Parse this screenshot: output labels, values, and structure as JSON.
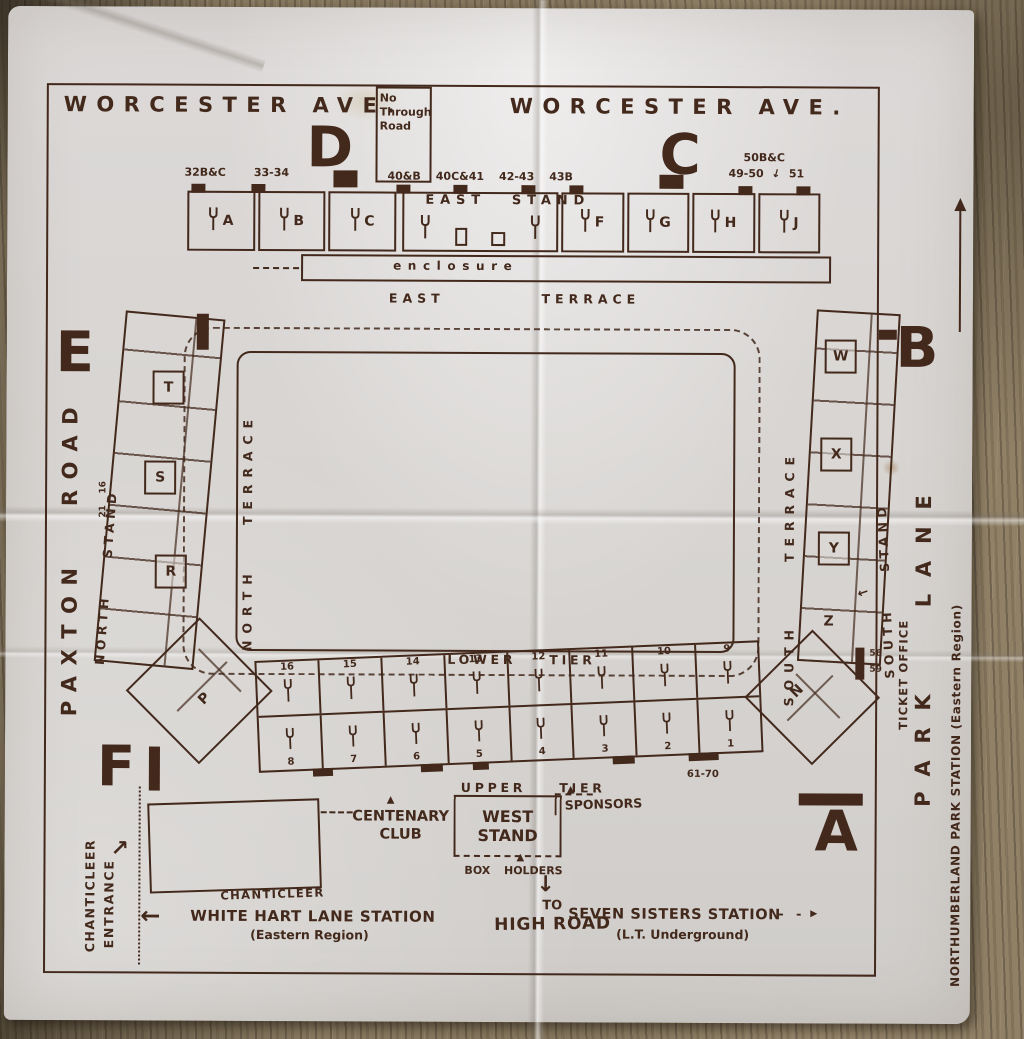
{
  "colors": {
    "ink": "#43291c",
    "ink-soft": "#5a4030",
    "paper": "#d8d5d2",
    "wood": "#87785f"
  },
  "glyphs": {
    "down_arrow": "↓",
    "left_arrow": "←",
    "right_arrow": "▸",
    "up_right_arrow": "↗",
    "triangle_up": "▲"
  },
  "streets": {
    "worcester_left": "WORCESTER AVE.",
    "worcester_right": "WORCESTER AVE.",
    "no_through_road": "No Through Road",
    "paxton_road": "PAXTON ROAD",
    "park_lane": "PARK LANE",
    "northumberland": "NORTHUMBERLAND PARK STATION (Eastern Region)"
  },
  "corner_letters": {
    "top_left": "D",
    "top_right": "C",
    "left_top": "E",
    "right_top": "B",
    "left_bottom": "F",
    "right_bottom": "A"
  },
  "gates": {
    "left": [
      "32B&C",
      "33-34"
    ],
    "middle": [
      "40&B",
      "40C&41",
      "42-43",
      "43B"
    ],
    "right_top": "50B&C",
    "right_row": [
      "49-50",
      "51"
    ]
  },
  "east_stand": {
    "label": "EAST STAND",
    "blocks_left": [
      "A",
      "B",
      "C"
    ],
    "blocks_right": [
      "F",
      "G",
      "H",
      "J"
    ],
    "enclosure": "enclosure"
  },
  "terraces": {
    "east": "EAST TERRACE",
    "north": "NORTH TERRACE",
    "south": "SOUTH TERRACE"
  },
  "north_stand": {
    "label": "NORTH STAND",
    "blocks": [
      "T",
      "S",
      "R"
    ],
    "corner_block": "P",
    "gate_top": "16",
    "gate_bottom": "21"
  },
  "south_stand": {
    "label": "SOUTH STAND",
    "blocks": [
      "W",
      "X",
      "Y",
      "Z"
    ],
    "corner_block": "N",
    "gate_top": "56",
    "gate_bottom": "59",
    "ticket_office": "TICKET OFFICE"
  },
  "west_stand": {
    "lower_tier": "LOWER TIER",
    "upper_tier": "UPPER TIER",
    "turnstiles_top": [
      "16",
      "15",
      "14",
      "13",
      "12",
      "11",
      "10",
      "9"
    ],
    "turnstiles_bottom": [
      "8",
      "7",
      "6",
      "5",
      "4",
      "3",
      "2",
      "1"
    ],
    "range_label": "61-70",
    "stand_name": "WEST STAND",
    "centenary_club": "CENTENARY CLUB",
    "sponsors": "SPONSORS",
    "box_holders": "BOX HOLDERS"
  },
  "bottom": {
    "to": "TO",
    "high_road": "HIGH ROAD",
    "whl_station": "WHITE HART LANE STATION",
    "whl_sub": "(Eastern Region)",
    "seven_sisters": "SEVEN SISTERS STATION",
    "seven_sisters_sub": "(L.T. Underground)",
    "chanticleer": "CHANTICLEER",
    "chant_entrance_col1": "CHANTICLEER",
    "chant_entrance_col2": "ENTRANCE"
  }
}
